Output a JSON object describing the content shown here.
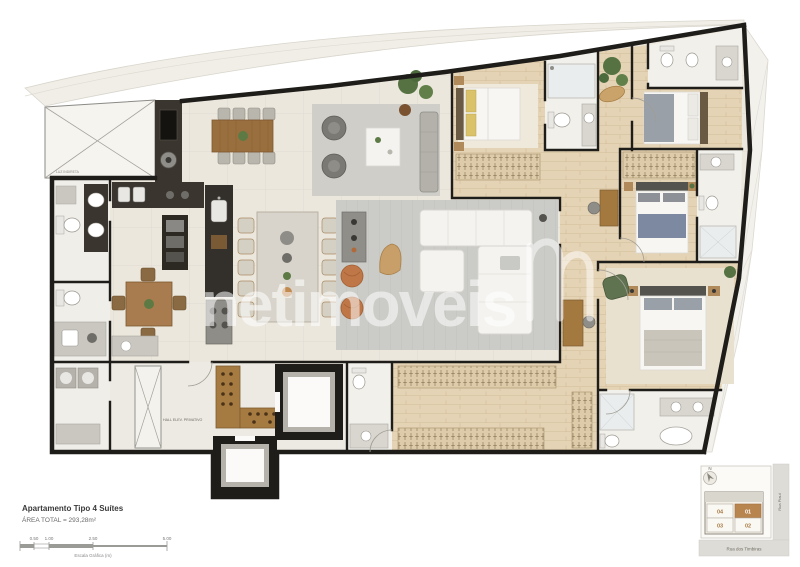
{
  "plan": {
    "watermark_text": "netimoveis",
    "hall_label": "HALL ELEV. PRIVATIVO",
    "terrace_label": "LUZ INDIRETA"
  },
  "footer": {
    "title": "Apartamento Tipo 4 Suítes",
    "area": "ÁREA TOTAL = 293,28m²",
    "scale_caption": "Escala Gráfica (m)",
    "scale_ticks": [
      "0.50",
      "1.00",
      "2.50",
      "5.00"
    ]
  },
  "keyplan": {
    "north_label": "N",
    "street_bottom": "Rua dos Timbiras",
    "street_right": "Rua Piauí",
    "units": [
      {
        "id": "04"
      },
      {
        "id": "01"
      },
      {
        "id": "03"
      },
      {
        "id": "02"
      }
    ],
    "highlighted_unit": "01",
    "highlight_color": "#b9854f"
  },
  "colors": {
    "wall": "#1f1d1a",
    "tile_floor": "#ebe7dd",
    "wood_floor": "#e4d3b4",
    "cabinet_dark": "#33302b",
    "accent_wood": "#a3793f",
    "rug_gray": "#cbcbc7",
    "keyplan_highlight": "#b9854f"
  }
}
